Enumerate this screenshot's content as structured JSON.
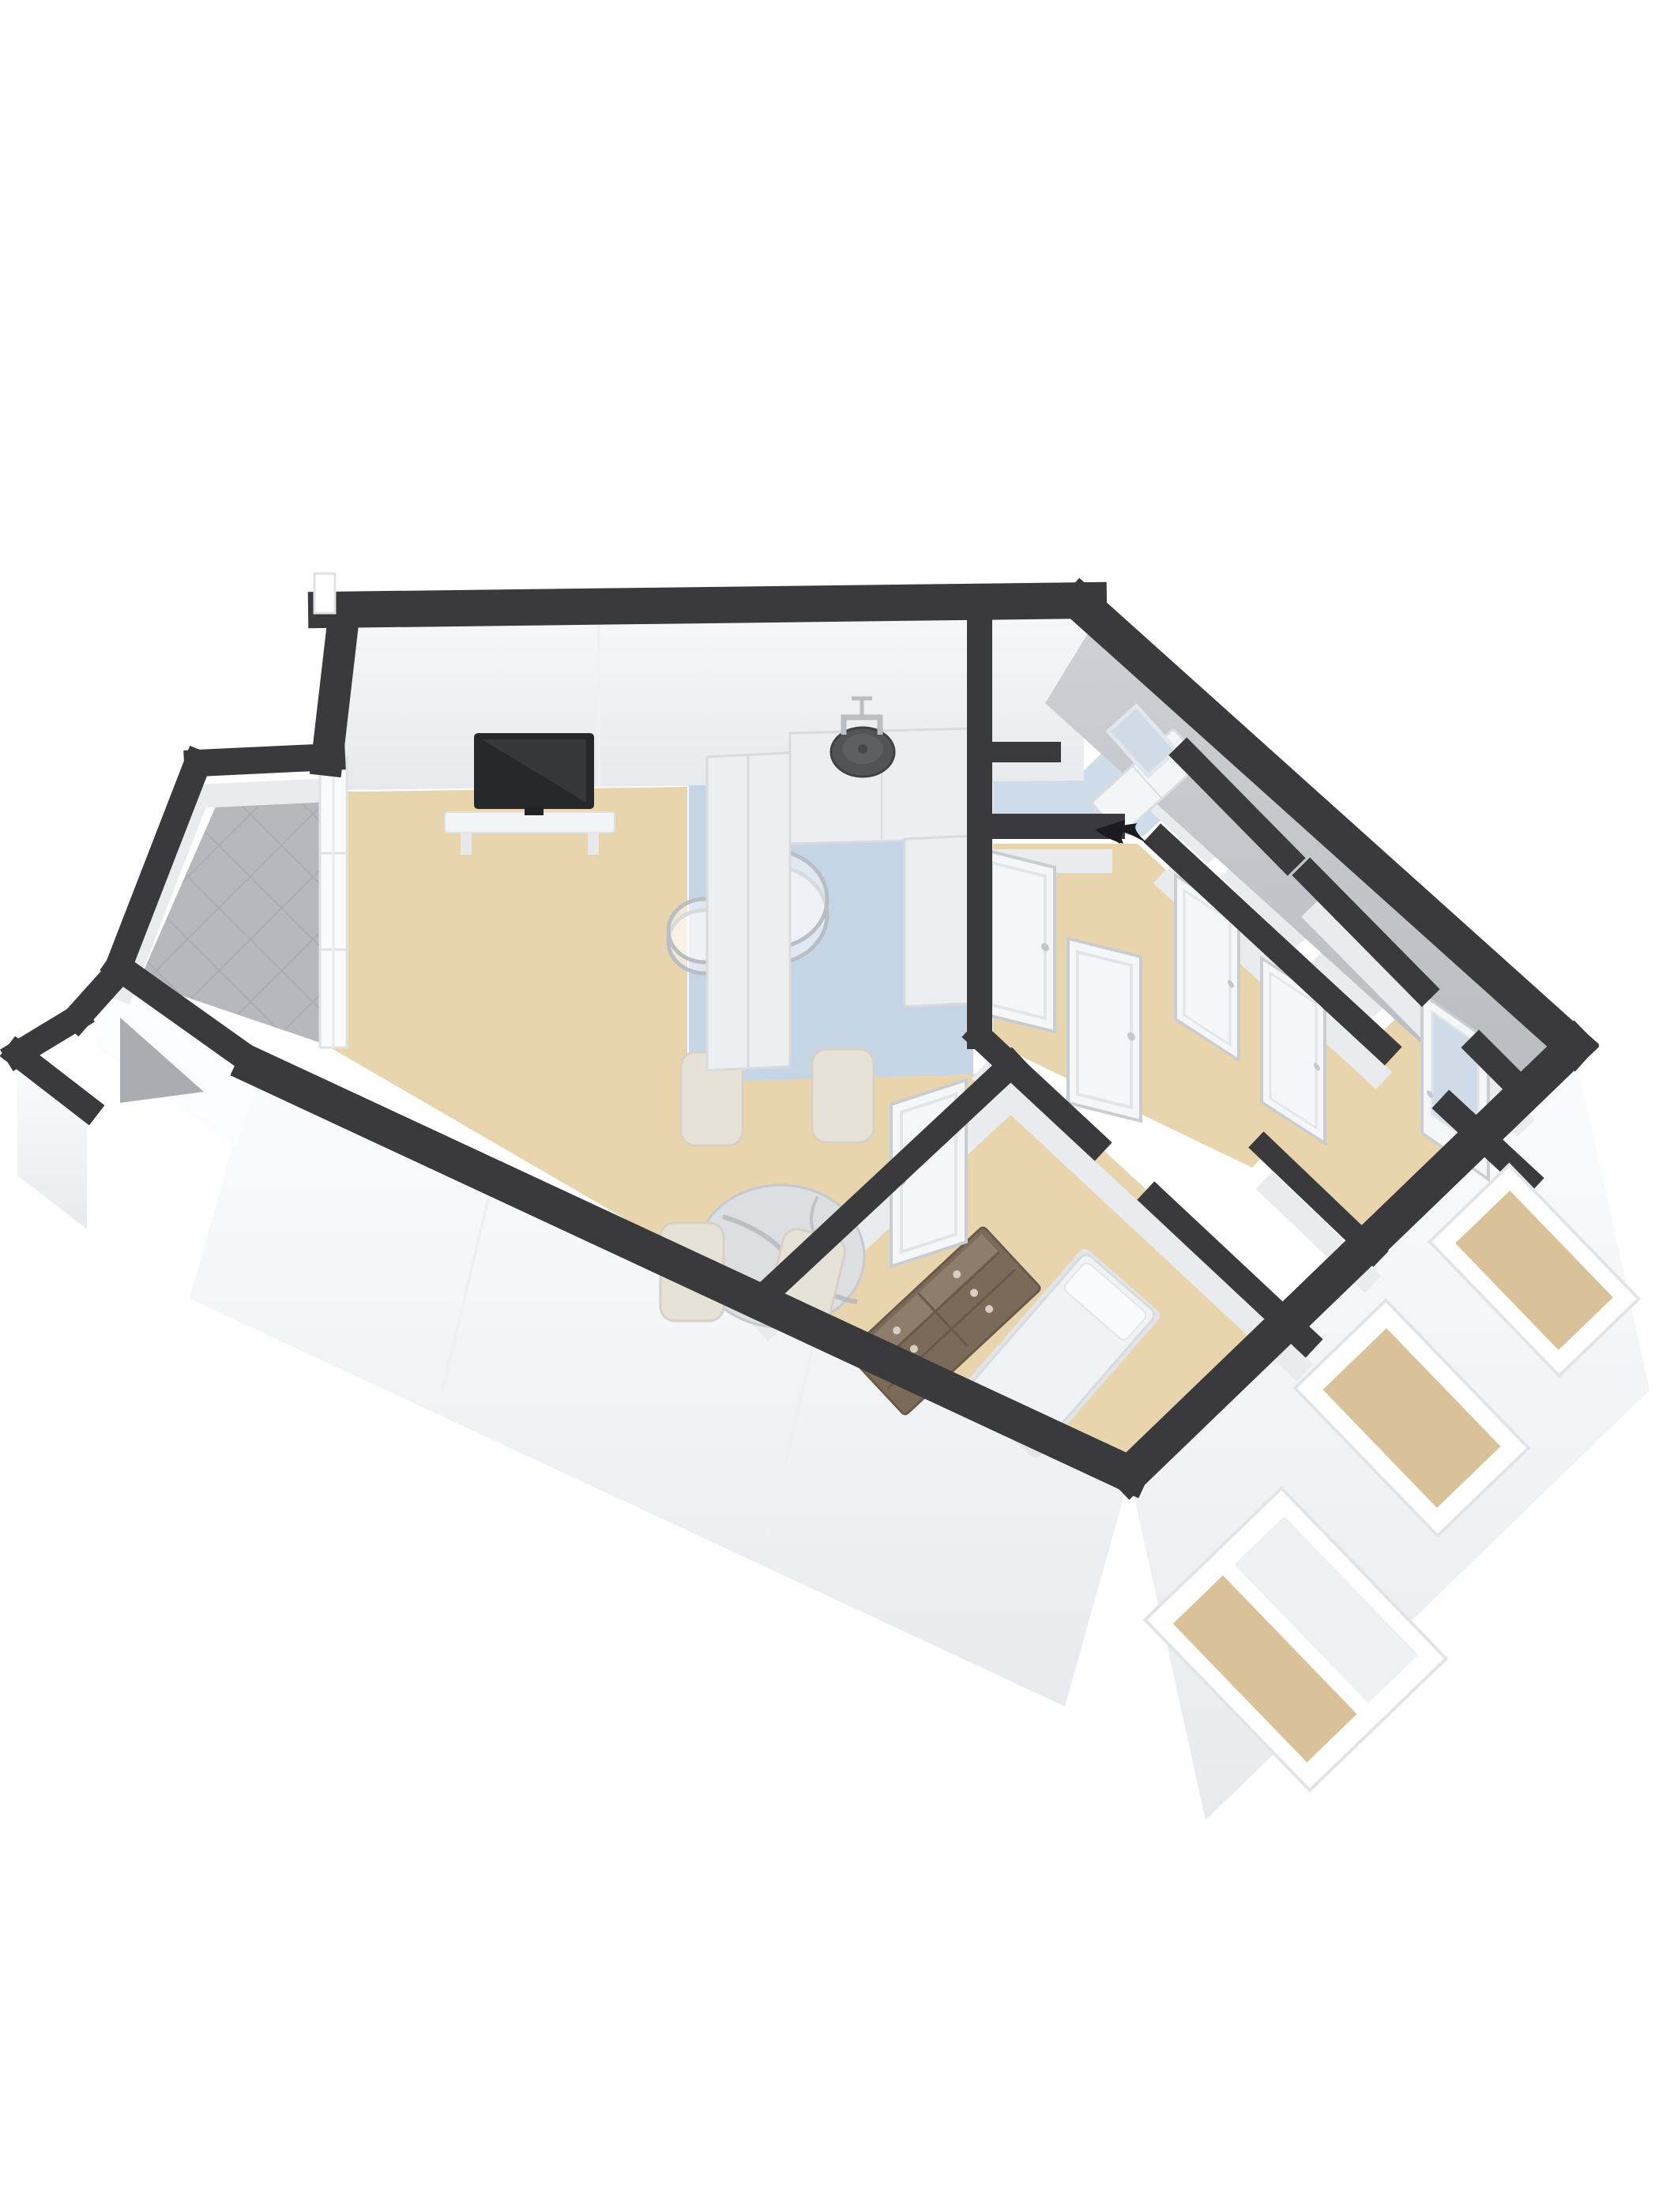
{
  "scene": {
    "type": "3d-floor-plan",
    "view": "axonometric-birdseye",
    "has_text": false,
    "background": "#ffffff"
  },
  "palette": {
    "bg": "#ffffff",
    "wall_dark": "#3a3a3c",
    "wall_face_white_top": "#f6f7f9",
    "wall_face_white_bottom": "#e7e9ed",
    "wall_face_gray_top": "#cdd0d4",
    "wall_face_gray_bottom": "#b7bac0",
    "wall_face_strip": "#e9ebee",
    "floor_wood": "#e8d4ad",
    "floor_blue": "#c6d5e5",
    "floor_blue_light": "#cfdce9",
    "floor_tile": "#b5b8bc",
    "tile_line": "#a7aaae",
    "floor_concrete": "#a9adb1",
    "exterior_white": "#fbfcfd",
    "exterior_seam": "#eef0f2",
    "exterior_shade": "#e8eaed",
    "counter_white": "#eceef0",
    "counter_edge": "#d8dadd",
    "door_white": "#f5f6f8",
    "door_frame": "#c9ccd0",
    "glass_blue": "#cfdce8",
    "window_interior": "#d9c199",
    "wood_dark": "#7c6a59",
    "wood_light": "#8f7d6b",
    "marble": "#dcdee2",
    "marble_vein": "#aeb1b8",
    "chair_cream": "#e6e2d8",
    "chair_cream_dark": "#d6d1c4",
    "bed_white": "#f1f2f4",
    "bed_edge": "#d9dbde",
    "tv_dark": "#27282b",
    "tv_screen": "#36373b",
    "shelf_white": "#f2f3f5",
    "metal": "#b9bec4",
    "sink_dark": "#515457",
    "arrow_black": "#1c1c1e"
  },
  "rooms": [
    {
      "id": "living-room",
      "floor": "floor_wood",
      "furniture": [
        "wall-tv",
        "tv-shelf",
        "nesting-glass-coffee-tables"
      ]
    },
    {
      "id": "dining-area",
      "floor": "floor_wood",
      "furniture": [
        "round-marble-dining-table",
        "cream-dining-chairs-x4"
      ]
    },
    {
      "id": "kitchen",
      "floor": "floor_blue",
      "furniture": [
        "u-shaped-counter",
        "round-sink",
        "chrome-faucet"
      ]
    },
    {
      "id": "entry-hall",
      "floor": "floor_blue",
      "furniture": [
        "credenza",
        "mirror"
      ],
      "marker": "entrance-arrow"
    },
    {
      "id": "corridor",
      "floor": "floor_wood",
      "furniture": []
    },
    {
      "id": "bath-wc-storage-cells",
      "floor": "wall_face_strip",
      "furniture": []
    },
    {
      "id": "bedroom-1",
      "floor": "floor_wood",
      "furniture": [
        "wooden-dresser",
        "single-bed"
      ]
    },
    {
      "id": "bedroom-2",
      "floor": "floor_wood",
      "furniture": []
    },
    {
      "id": "balcony-upper",
      "floor": "floor_tile",
      "furniture": []
    },
    {
      "id": "balcony-lower",
      "floor": "floor_concrete",
      "furniture": []
    }
  ],
  "openings": {
    "white_doors": 5,
    "frosted_glass_doors": 1,
    "exterior_windows": 3,
    "balcony_french_windows": 1
  },
  "entry": {
    "marker": "black-arrow",
    "location": "hall-south-wall"
  }
}
